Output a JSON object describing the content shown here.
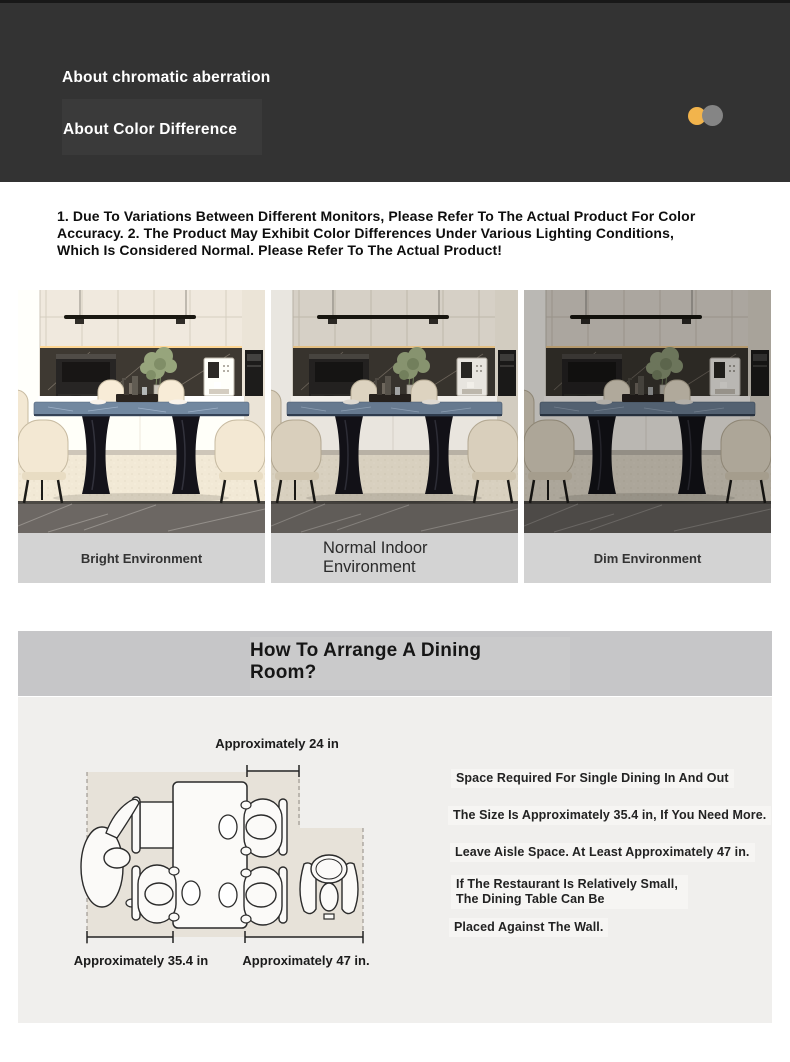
{
  "header": {
    "line1": "About chromatic aberration",
    "line2": "About Color Difference"
  },
  "disclaimer": "1. Due To Variations Between Different Monitors, Please Refer To The Actual Product For Color Accuracy. 2. The Product May Exhibit Color Differences Under Various Lighting Conditions, Which Is Considered Normal. Please Refer To The Actual Product!",
  "environments": [
    {
      "label": "Bright Environment"
    },
    {
      "label": "Normal Indoor Environment"
    },
    {
      "label": "Dim Environment"
    }
  ],
  "arrange": {
    "title_line1": "How To Arrange A Dining",
    "title_line2": "Room?",
    "dim_top": "Approximately 24 in",
    "dim_left": "Approximately 35.4 in",
    "dim_right": "Approximately 47 in.",
    "notes": [
      "Space Required For Single Dining In And Out",
      "The Size Is Approximately 35.4 in, If You Need More.",
      "Leave Aisle Space. At Least Approximately 47 in.",
      "If The Restaurant Is Relatively Small, The Dining Table Can Be",
      "Placed Against The Wall."
    ]
  },
  "colors": {
    "accent_orange": "#f2b44c",
    "accent_gray": "#858585",
    "header_bg": "#333333",
    "caption_bg": "#d3d3d3",
    "banner_bg": "#c6c6c8",
    "section_bg": "#f0efed"
  }
}
